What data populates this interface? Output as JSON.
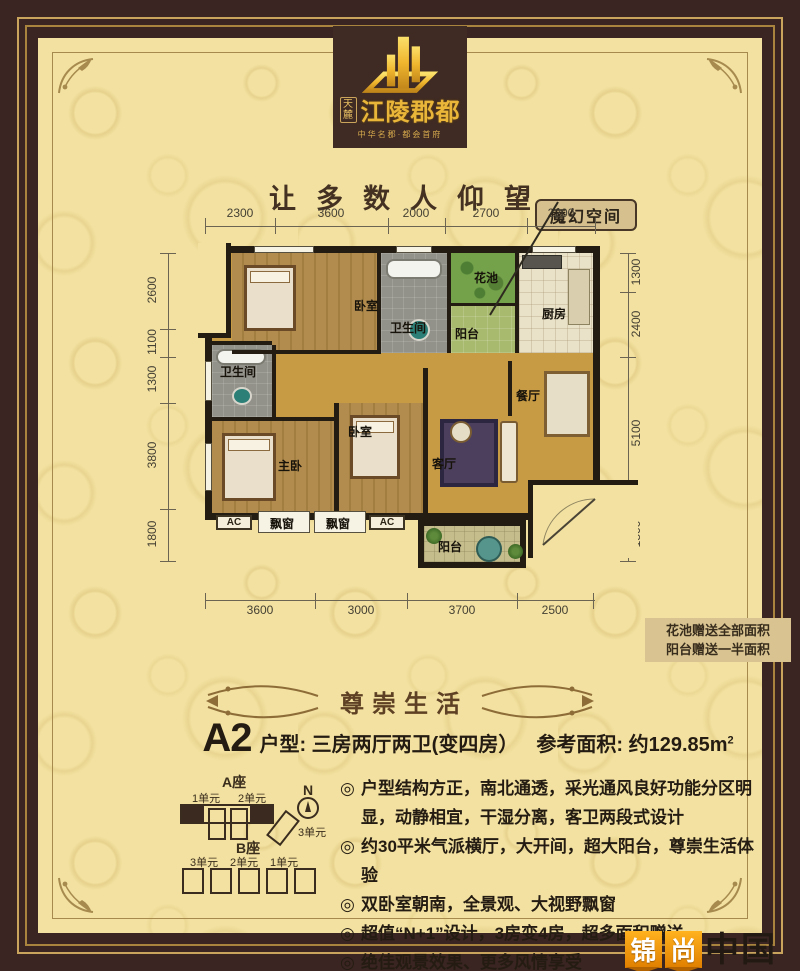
{
  "brand": {
    "seal": "天麓",
    "name": "江陵郡都",
    "subtitle": "中华名郡·都会首府",
    "tagline": "让多数人仰望",
    "callout": "魔幻空间"
  },
  "floorplan": {
    "dims_top": [
      "2300",
      "3600",
      "2000",
      "2700",
      "2200"
    ],
    "dims_left": [
      "2600",
      "1100",
      "1300",
      "3800",
      "1800"
    ],
    "dims_right": [
      "1300",
      "2400",
      "5100",
      "1800"
    ],
    "dims_bottom": [
      "3600",
      "3000",
      "3700",
      "2500"
    ],
    "rooms": {
      "bedroom_top": "卧室",
      "bath_top": "卫生间",
      "flower_bed": "花池",
      "balcony_top": "阳台",
      "kitchen": "厨房",
      "bath_left": "卫生间",
      "master_bedroom": "主卧",
      "bedroom_mid": "卧室",
      "living_room": "客厅",
      "dining_room": "餐厅",
      "balcony_bottom": "阳台"
    },
    "ac_label": "AC",
    "bay_window": "飘窗",
    "note_line1": "花池赠送全部面积",
    "note_line2": "阳台赠送一半面积"
  },
  "details": {
    "section_title": "尊崇生活",
    "unit_code": "A2",
    "unit_type": "户型: 三房两厅两卫(变四房）",
    "area": "参考面积: 约129.85m",
    "area_sup": "2",
    "bullet_glyph": "◎",
    "bullets": [
      "户型结构方正，南北通透，采光通风良好功能分区明显，动静相宜，干湿分离，客卫两段式设计",
      "约30平米气派横厅，大开间，超大阳台，尊崇生活体验",
      "双卧室朝南，全景观、大视野飘窗",
      "超值“N+1”设计，3房变4房，超多面积赠送",
      "绝佳观景效果、更多风情享受"
    ]
  },
  "sitemap": {
    "block_a": "A座",
    "block_b": "B座",
    "a_unit_1": "1单元",
    "a_unit_2": "2单元",
    "a_unit_3": "3单元",
    "b_unit_3": "3单元",
    "b_unit_2": "2单元",
    "b_unit_1": "1单元",
    "compass_n": "N"
  },
  "watermark": {
    "char1": "锦",
    "char2": "尚",
    "suffix": "中国"
  },
  "colors": {
    "border_brown": "#3a2522",
    "accent_gold": "#c9a45c",
    "page_bg": "#f2e1a0",
    "logo_gold": "#e9b63a"
  }
}
